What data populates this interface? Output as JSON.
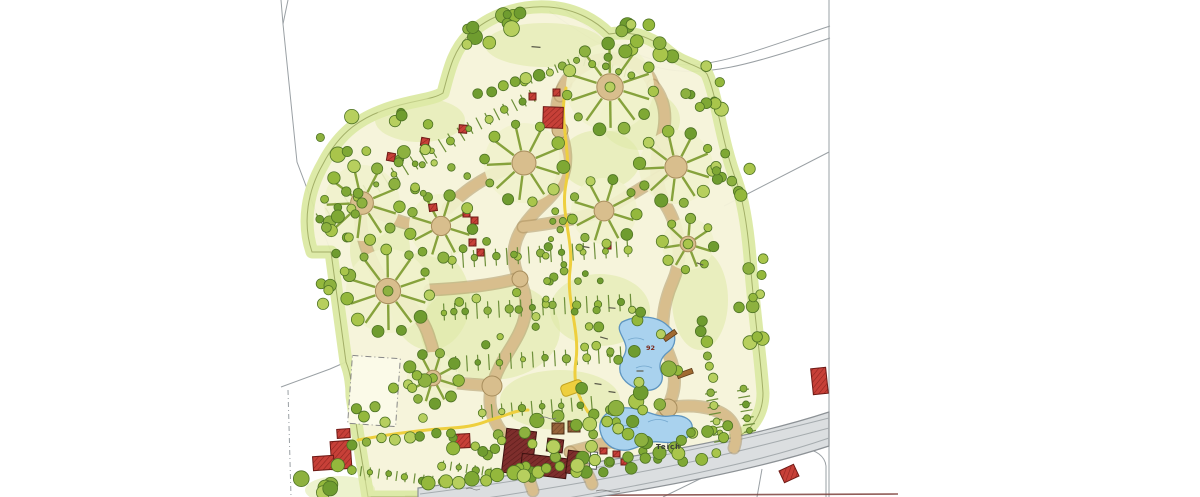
{
  "map": {
    "labels": {
      "pond_upper_number": "92",
      "pond_lower_name": "Teich"
    },
    "palette": {
      "paper": "#ffffff",
      "ground": "#f6f4da",
      "meadow": "#dfe9a6",
      "band": "#dce9a4",
      "outline": "#a3af68",
      "wheelFill": "#f1f2cc",
      "greens": [
        "#a9c54b",
        "#94b83c",
        "#7fa834",
        "#b7cf5e",
        "#6f9c2f",
        "#8db13f"
      ],
      "treeStroke": "#4e7324",
      "spoke": "#86a23c",
      "comb": "#6d8f3a",
      "path": "#d8be8d",
      "pathStroke": "#a78d5c",
      "road": "#dbdee0",
      "roadStroke": "#8d9296",
      "pond": "#a9d2ee",
      "pondStroke": "#5e95c0",
      "boundary": "#9aa0a4",
      "scanline": "#7c413b",
      "yellow": "#eecf3e",
      "yellowStroke": "#c3a322",
      "labelDark": "#3a3a3a",
      "labelRed": "#7a2a1e"
    },
    "site_outline_d": "M312,252 C302,222 308,190 323,164 C340,131 362,117 390,108 C414,100 432,100 443,93 C449,71 453,51 469,35 C489,15 521,5 549,7 C577,9 597,22 609,34 C633,30 653,38 669,52 C683,64 700,65 707,74 C717,96 721,140 736,180 C745,205 749,240 751,271 C755,321 761,361 763,393 C763,415 752,429 735,439 C716,448 689,456 658,463 C617,471 568,481 529,488 C498,493 469,495 446,496 L418,497 L368,497 L358,436 L352,396 C352,382 350,372 346,362 L331,252 Z",
    "meadows": [
      [
        545,
        45,
        60,
        22
      ],
      [
        490,
        330,
        70,
        50
      ],
      [
        600,
        310,
        50,
        36
      ],
      [
        430,
        300,
        40,
        50
      ],
      [
        560,
        400,
        60,
        30
      ],
      [
        380,
        250,
        30,
        40
      ],
      [
        640,
        120,
        40,
        30
      ],
      [
        700,
        300,
        28,
        50
      ],
      [
        420,
        120,
        45,
        22
      ],
      [
        600,
        160,
        40,
        30
      ],
      [
        340,
        490,
        35,
        14
      ]
    ],
    "sports_field": [
      350,
      357,
      48,
      68,
      4
    ],
    "boundaries": [
      {
        "d": "M281,0 L283,24 L297,162 L331,252 L346,362 L352,380",
        "dash": ""
      },
      {
        "d": "M288,0 L283,24",
        "dash": ""
      },
      {
        "d": "M346,362 L330,369 L281,387",
        "dash": ""
      },
      {
        "d": "M288,390 L291,497",
        "dash": "5,3,1,3"
      },
      {
        "d": "M556,4 C596,34 622,52 662,62 C704,72 746,54 830,26",
        "dash": ""
      },
      {
        "d": "M549,11 C590,40 620,58 660,68 C702,78 748,66 830,38",
        "dash": ""
      },
      {
        "d": "M829,0 L829,497",
        "dash": ""
      },
      {
        "d": "M829,152 L724,206",
        "dash": ""
      },
      {
        "d": "M663,497 L753,453 C772,449 792,446 803,448 C816,450 825,456 826,466 L826,497",
        "dash": ""
      },
      {
        "d": "M757,497 L762,469",
        "dash": ""
      },
      {
        "d": "M350,380 L358,436 L368,497",
        "dash": ""
      }
    ],
    "scan_line_d": "M405,496 L898,494",
    "tan_paths": [
      "M533,491 C526,468 515,449 503,434 C491,418 487,402 492,386 C499,362 512,349 520,331 C529,312 527,294 519,278 C511,261 512,243 523,227 C535,208 553,199 561,181 C569,163 566,146 560,130 C554,112 556,96 566,84",
      "M560,96 C564,76 584,61 606,59 C630,57 648,68 653,85",
      "M653,85 C667,102 667,122 661,141 C653,166 656,190 668,209 C680,231 683,258 673,281 C662,306 659,333 669,355 C677,374 676,392 667,408 C657,427 637,437 616,441 C600,444 585,448 570,452",
      "M524,163 C500,170 472,182 448,208",
      "M441,226 C415,230 388,218 366,206",
      "M362,203 C356,230 368,258 388,291",
      "M388,291 C410,302 424,318 430,340 C436,356 434,366 433,378",
      "M433,378 C452,384 472,384 492,386",
      "M519,278 C498,284 470,288 430,290",
      "M604,211 C580,218 550,224 523,227",
      "M676,167 C652,182 628,196 604,211",
      "M661,141 C668,150 674,158 676,167",
      "M668,408 C690,404 712,406 726,416 C736,424 738,436 734,448",
      "M570,452 C580,462 588,472 592,484"
    ],
    "plazas": [
      [
        492,
        386,
        10
      ],
      [
        520,
        279,
        8
      ],
      [
        560,
        130,
        8
      ],
      [
        668,
        408,
        9
      ],
      [
        616,
        441,
        8
      ]
    ],
    "wheels": [
      [
        362,
        203,
        38,
        9
      ],
      [
        441,
        226,
        32,
        8
      ],
      [
        388,
        291,
        42,
        10
      ],
      [
        433,
        378,
        26,
        8
      ],
      [
        524,
        163,
        40,
        9
      ],
      [
        610,
        87,
        44,
        10
      ],
      [
        676,
        167,
        37,
        9
      ],
      [
        604,
        211,
        33,
        8
      ],
      [
        688,
        244,
        26,
        7
      ]
    ],
    "combs": [
      [
        320,
        220,
        468,
        130,
        15,
        11
      ],
      [
        470,
        128,
        540,
        92,
        13,
        10
      ],
      [
        452,
        260,
        636,
        248,
        17,
        11
      ],
      [
        444,
        312,
        636,
        302,
        17,
        11
      ],
      [
        456,
        364,
        628,
        354,
        16,
        11
      ],
      [
        482,
        412,
        592,
        403,
        14,
        10
      ],
      [
        524,
        82,
        570,
        63,
        9,
        7
      ],
      [
        578,
        60,
        638,
        76,
        9,
        7
      ],
      [
        352,
        470,
        456,
        484,
        10,
        9
      ],
      [
        443,
        465,
        497,
        473,
        9,
        8
      ],
      [
        711,
        393,
        721,
        446,
        12,
        7
      ],
      [
        743,
        390,
        751,
        437,
        12,
        7
      ]
    ],
    "tree_clusters": [
      [
        380,
        135,
        60,
        28,
        12,
        4,
        8
      ],
      [
        505,
        30,
        55,
        20,
        12,
        4,
        8
      ],
      [
        640,
        45,
        45,
        22,
        10,
        4,
        8
      ],
      [
        700,
        90,
        30,
        35,
        9,
        4,
        8
      ],
      [
        735,
        160,
        22,
        40,
        9,
        4,
        7
      ],
      [
        752,
        300,
        16,
        60,
        10,
        4,
        7
      ],
      [
        640,
        390,
        60,
        40,
        16,
        4,
        8
      ],
      [
        620,
        330,
        50,
        30,
        10,
        3,
        6
      ],
      [
        560,
        440,
        40,
        25,
        10,
        4,
        8
      ],
      [
        480,
        440,
        35,
        22,
        8,
        4,
        7
      ],
      [
        395,
        400,
        40,
        35,
        9,
        4,
        7
      ],
      [
        330,
        270,
        18,
        45,
        8,
        4,
        7
      ],
      [
        330,
        480,
        30,
        16,
        7,
        4,
        8
      ],
      [
        585,
        470,
        70,
        14,
        10,
        4,
        7
      ],
      [
        680,
        450,
        45,
        14,
        9,
        4,
        7
      ],
      [
        500,
        300,
        80,
        60,
        18,
        2.5,
        4.5
      ],
      [
        570,
        250,
        60,
        40,
        12,
        2.5,
        4.5
      ],
      [
        430,
        170,
        40,
        25,
        8,
        3,
        5
      ],
      [
        710,
        430,
        20,
        12,
        6,
        4,
        6
      ],
      [
        350,
        215,
        20,
        30,
        6,
        4,
        7
      ]
    ],
    "tree_rows": [
      [
        430,
        485,
        540,
        472,
        9,
        5,
        8
      ],
      [
        352,
        443,
        450,
        432,
        8,
        4,
        6
      ],
      [
        605,
        420,
        640,
        440,
        4,
        5,
        7
      ],
      [
        700,
        320,
        712,
        380,
        6,
        4,
        6
      ],
      [
        480,
        95,
        540,
        75,
        6,
        4,
        6
      ],
      [
        545,
        468,
        660,
        454,
        8,
        4,
        7
      ]
    ],
    "road": {
      "outline_d": "M418,488 C480,480 560,468 640,455 C720,442 780,428 829,412 L829,446 C780,462 720,476 640,490 C575,501 520,508 470,514 L418,520 Z",
      "lines": [
        "M420,494 C500,484 600,468 690,450 C740,440 790,428 829,418",
        "M436,505 C520,494 620,477 700,460 C750,449 795,437 829,428",
        "M452,516 C540,504 640,486 720,468 C765,458 800,448 829,438"
      ]
    },
    "yellow_paths": [
      "M358,440 C390,434 420,430 452,428 C470,427 480,424 490,420 C505,416 515,410 528,410",
      "M566,88 C558,120 572,150 566,184 C560,214 574,240 570,270 C566,300 580,330 576,360 C572,385 580,400 588,412"
    ],
    "yellow_marquee": [
      572,
      388,
      22,
      12,
      -20
    ],
    "ponds": [
      {
        "d": "M622,322 C638,314 658,316 668,326 C678,334 676,346 668,352 C660,358 658,366 662,374 C664,384 656,392 644,390 C630,388 618,378 620,366 C621,358 626,356 626,348 C626,338 614,330 622,322 Z"
      },
      {
        "d": "M600,430 C598,416 612,406 630,408 C648,410 656,418 670,416 C684,414 694,420 692,430 C690,440 676,444 660,442 C646,440 640,448 628,450 C612,452 602,442 600,430 Z"
      }
    ],
    "pond_waves": [
      "M628,340 q8,-4 16,0",
      "M636,368 q8,-4 16,0",
      "M618,428 q10,-5 20,0",
      "M648,422 q10,-5 20,0"
    ],
    "piers": [
      [
        663,
        333,
        14,
        5,
        -35
      ],
      [
        677,
        371,
        16,
        5,
        -20
      ]
    ],
    "buildings": [
      [
        504,
        430,
        30,
        44,
        7,
        "maroon"
      ],
      [
        521,
        456,
        46,
        20,
        7,
        "maroon"
      ],
      [
        547,
        439,
        16,
        13,
        7,
        "maroon"
      ],
      [
        567,
        451,
        15,
        23,
        7,
        "maroon"
      ],
      [
        552,
        423,
        12,
        11,
        0,
        "brown"
      ],
      [
        568,
        421,
        12,
        11,
        0,
        "brown"
      ],
      [
        590,
        452,
        7,
        17,
        5,
        "white"
      ],
      [
        331,
        441,
        20,
        28,
        -4,
        "red"
      ],
      [
        313,
        456,
        21,
        14,
        -4,
        "red"
      ],
      [
        337,
        429,
        13,
        9,
        -4,
        "red"
      ],
      [
        452,
        434,
        18,
        14,
        -3,
        "red"
      ],
      [
        812,
        368,
        15,
        26,
        -6,
        "red"
      ],
      [
        781,
        467,
        16,
        13,
        -25,
        "red"
      ],
      [
        543,
        107,
        20,
        21,
        2,
        "red"
      ],
      [
        387,
        153,
        8,
        8,
        10,
        "red"
      ],
      [
        421,
        138,
        8,
        8,
        10,
        "red"
      ],
      [
        459,
        125,
        8,
        8,
        5,
        "red"
      ],
      [
        429,
        204,
        8,
        7,
        -8,
        "red"
      ],
      [
        463,
        210,
        7,
        7,
        0,
        "red"
      ],
      [
        471,
        217,
        7,
        7,
        0,
        "red"
      ],
      [
        529,
        93,
        7,
        7,
        0,
        "red"
      ],
      [
        553,
        89,
        7,
        7,
        0,
        "red"
      ],
      [
        604,
        242,
        7,
        7,
        0,
        "red"
      ],
      [
        469,
        239,
        7,
        7,
        0,
        "red"
      ],
      [
        477,
        249,
        7,
        7,
        0,
        "red"
      ],
      [
        600,
        448,
        7,
        6,
        0,
        "red"
      ],
      [
        613,
        451,
        7,
        6,
        0,
        "red"
      ],
      [
        621,
        459,
        6,
        6,
        0,
        "red"
      ]
    ],
    "dash_marks": [
      [
        536,
        47,
        5,
        9
      ],
      [
        604,
        338,
        15,
        8
      ],
      [
        598,
        384,
        8,
        7
      ],
      [
        612,
        392,
        8,
        7
      ],
      [
        640,
        371,
        0,
        7
      ],
      [
        586,
        247,
        10,
        7
      ],
      [
        700,
        264,
        20,
        7
      ],
      [
        612,
        308,
        5,
        7
      ]
    ],
    "squiggles": [
      [
        596,
        491,
        24
      ],
      [
        466,
        489,
        14
      ],
      [
        540,
        418,
        16
      ]
    ],
    "label_positions": {
      "pond_upper": [
        646,
        350
      ],
      "pond_lower": [
        656,
        449
      ]
    }
  }
}
